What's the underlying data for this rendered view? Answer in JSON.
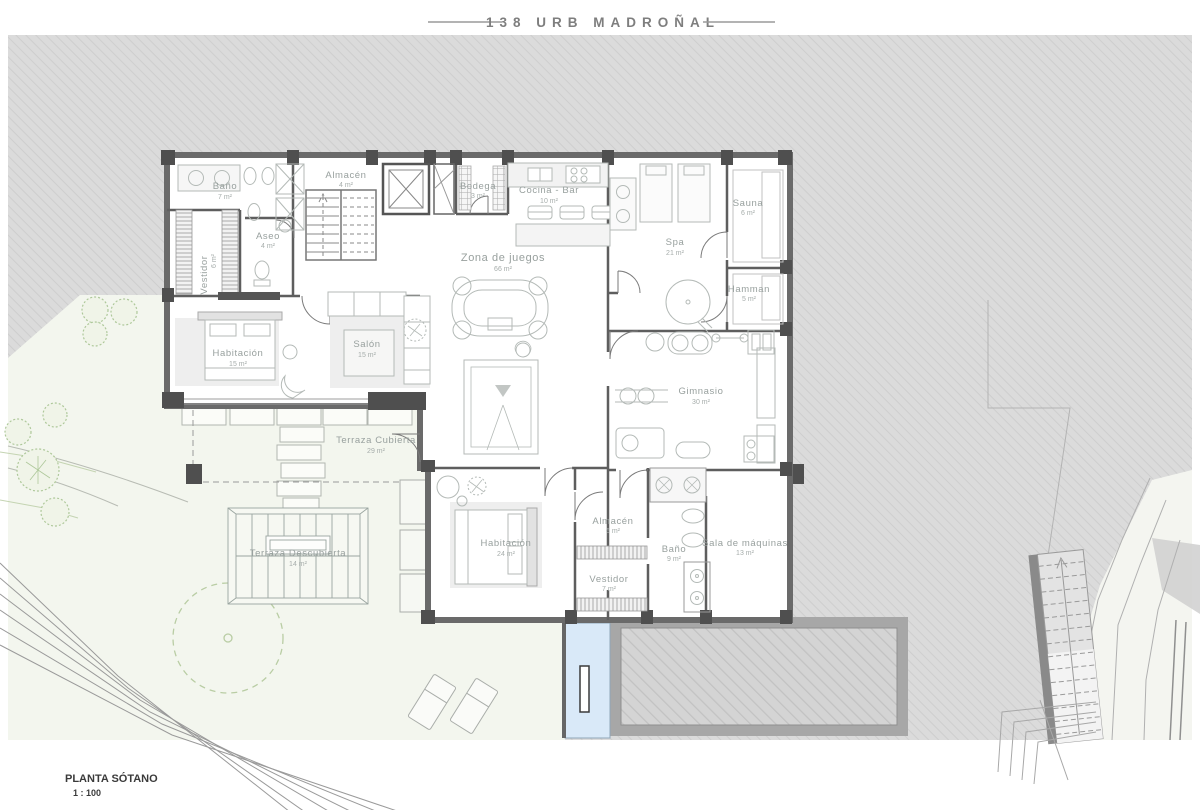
{
  "title": {
    "text": "138 URB MADROÑAL"
  },
  "footer": {
    "label": "PLANTA SÓTANO",
    "scale": "1 : 100"
  },
  "colors": {
    "terrain_gray": "#dbdbdb",
    "terrain_hatch_line": "#cecece",
    "garden_green": "#f3f6ee",
    "slope_white": "#f4f5f0",
    "pool_blue": "#d9e9f8",
    "wall_dark": "#5e5e5e",
    "label_gray": "#98a09e",
    "tree_green": "#aec89a"
  },
  "rooms": [
    {
      "name": "Baño",
      "area": "7 m²"
    },
    {
      "name": "Vestidor",
      "area": "6 m²"
    },
    {
      "name": "Aseo",
      "area": "4 m²"
    },
    {
      "name": "Almacén",
      "area": "4 m²"
    },
    {
      "name": "Bodega",
      "area": "3 m²"
    },
    {
      "name": "Cocina - Bar",
      "area": "10 m²"
    },
    {
      "name": "Zona de juegos",
      "area": "66 m²"
    },
    {
      "name": "Spa",
      "area": "21 m²"
    },
    {
      "name": "Sauna",
      "area": "6 m²"
    },
    {
      "name": "Hamman",
      "area": "5 m²"
    },
    {
      "name": "Habitación",
      "area": "15 m²"
    },
    {
      "name": "Salón",
      "area": "15 m²"
    },
    {
      "name": "Gimnasio",
      "area": "30 m²"
    },
    {
      "name": "Terraza Cubierta",
      "area": "29 m²"
    },
    {
      "name": "Terraza Descubierta",
      "area": "14 m²"
    },
    {
      "name": "Habitación",
      "area": "24 m²"
    },
    {
      "name": "Almacén",
      "area": "6 m²"
    },
    {
      "name": "Vestidor",
      "area": "7 m²"
    },
    {
      "name": "Baño",
      "area": "9 m²"
    },
    {
      "name": "Sala de máquinas",
      "area": "13 m²"
    }
  ]
}
